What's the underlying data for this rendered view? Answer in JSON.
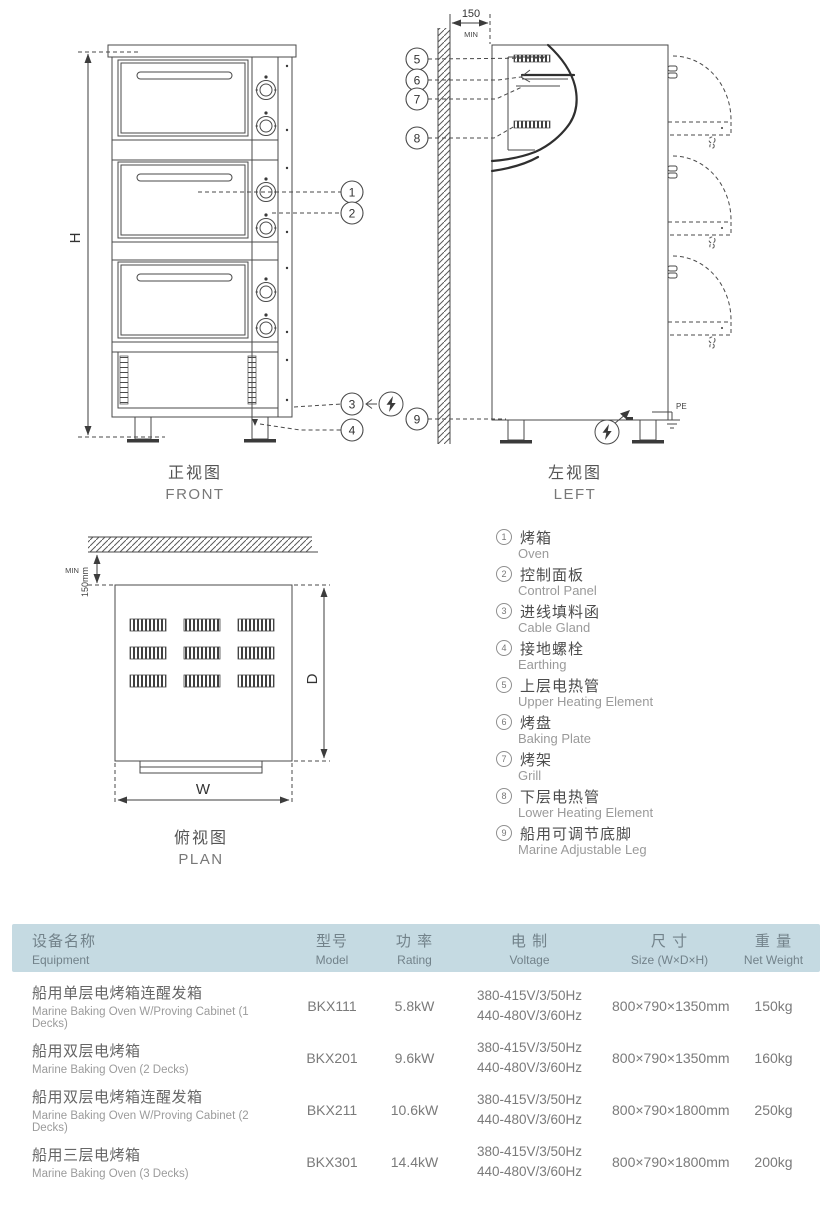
{
  "colors": {
    "table_header_bg": "#c5dae2",
    "line": "#4a4a4a",
    "text_gray": "#777777"
  },
  "drawing": {
    "front": {
      "title_cn": "正视图",
      "title_en": "FRONT",
      "height_label": "H"
    },
    "left": {
      "title_cn": "左视图",
      "title_en": "LEFT",
      "clearance": "150",
      "clearance_unit": "MIN",
      "pe_label": "PE"
    },
    "plan": {
      "title_cn": "俯视图",
      "title_en": "PLAN",
      "width_label": "W",
      "depth_label": "D",
      "clearance": "150mm",
      "clearance_unit": "MIN"
    }
  },
  "legend": {
    "items": [
      {
        "num": "1",
        "cn": "烤箱",
        "en": "Oven"
      },
      {
        "num": "2",
        "cn": "控制面板",
        "en": "Control Panel"
      },
      {
        "num": "3",
        "cn": "进线填料函",
        "en": "Cable Gland"
      },
      {
        "num": "4",
        "cn": "接地螺栓",
        "en": "Earthing"
      },
      {
        "num": "5",
        "cn": "上层电热管",
        "en": "Upper Heating Element"
      },
      {
        "num": "6",
        "cn": "烤盘",
        "en": "Baking Plate"
      },
      {
        "num": "7",
        "cn": "烤架",
        "en": "Grill"
      },
      {
        "num": "8",
        "cn": "下层电热管",
        "en": "Lower Heating Element"
      },
      {
        "num": "9",
        "cn": "船用可调节底脚",
        "en": "Marine Adjustable Leg"
      }
    ]
  },
  "table": {
    "headers": [
      {
        "cn": "设备名称",
        "en": "Equipment"
      },
      {
        "cn": "型号",
        "en": "Model"
      },
      {
        "cn": "功 率",
        "en": "Rating"
      },
      {
        "cn": "电 制",
        "en": "Voltage"
      },
      {
        "cn": "尺 寸",
        "en": "Size (W×D×H)"
      },
      {
        "cn": "重 量",
        "en": "Net Weight"
      }
    ],
    "rows": [
      {
        "name_cn": "船用单层电烤箱连醒发箱",
        "name_en": "Marine Baking Oven W/Proving Cabinet (1 Decks)",
        "model": "BKX111",
        "rating": "5.8kW",
        "voltage1": "380-415V/3/50Hz",
        "voltage2": "440-480V/3/60Hz",
        "size": "800×790×1350mm",
        "weight": "150kg"
      },
      {
        "name_cn": "船用双层电烤箱",
        "name_en": "Marine Baking Oven (2 Decks)",
        "model": "BKX201",
        "rating": "9.6kW",
        "voltage1": "380-415V/3/50Hz",
        "voltage2": "440-480V/3/60Hz",
        "size": "800×790×1350mm",
        "weight": "160kg"
      },
      {
        "name_cn": "船用双层电烤箱连醒发箱",
        "name_en": "Marine Baking Oven W/Proving Cabinet (2 Decks)",
        "model": "BKX211",
        "rating": "10.6kW",
        "voltage1": "380-415V/3/50Hz",
        "voltage2": "440-480V/3/60Hz",
        "size": "800×790×1800mm",
        "weight": "250kg"
      },
      {
        "name_cn": "船用三层电烤箱",
        "name_en": "Marine Baking Oven (3 Decks)",
        "model": "BKX301",
        "rating": "14.4kW",
        "voltage1": "380-415V/3/50Hz",
        "voltage2": "440-480V/3/60Hz",
        "size": "800×790×1800mm",
        "weight": "200kg"
      }
    ]
  }
}
